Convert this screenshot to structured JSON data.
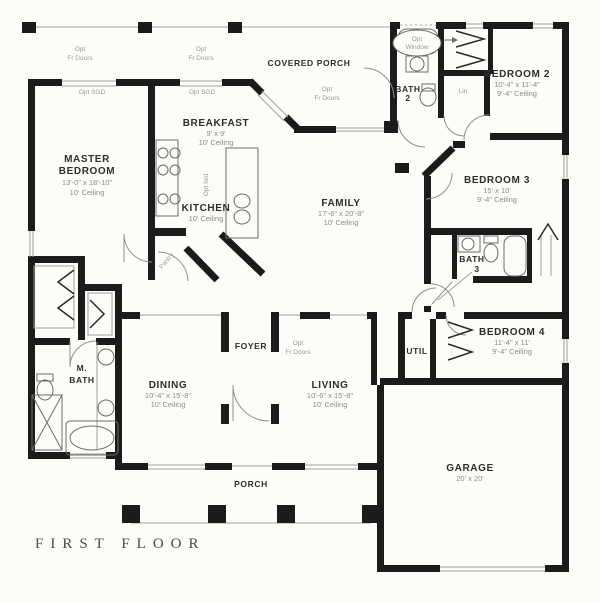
{
  "page": {
    "background": "#fcfcf8"
  },
  "colors": {
    "wall": "#1b1b1b",
    "thin_line": "#a0a0a0",
    "room_label": "#2e2e2e",
    "dim_label": "#8b8b8b",
    "annotation": "#9a9a9a",
    "title": "#4a4a4a"
  },
  "title": {
    "text": "FIRST FLOOR"
  },
  "rooms": {
    "covered_porch": {
      "name": "COVERED PORCH"
    },
    "master": {
      "line1": "MASTER",
      "line2": "BEDROOM",
      "dims": "13'-0\" x 18'-10\"",
      "ceiling": "10' Ceiling"
    },
    "breakfast": {
      "name": "BREAKFAST",
      "dims": "9' x 9'",
      "ceiling": "10' Ceiling"
    },
    "kitchen": {
      "name": "KITCHEN",
      "ceiling": "10' Ceiling"
    },
    "family": {
      "name": "FAMILY",
      "dims": "17'-6\" x 20'-8\"",
      "ceiling": "10' Ceiling"
    },
    "bath2": {
      "line1": "BATH",
      "line2": "2"
    },
    "bedroom2": {
      "name": "BEDROOM 2",
      "dims": "10'-4\" x 11'-4\"",
      "ceiling": "9'-4\" Ceiling"
    },
    "bedroom3": {
      "name": "BEDROOM 3",
      "dims": "15' x 10'",
      "ceiling": "9'-4\" Ceiling"
    },
    "bath3": {
      "line1": "BATH",
      "line2": "3"
    },
    "bedroom4": {
      "name": "BEDROOM 4",
      "dims": "11'-4\" x 11'",
      "ceiling": "9'-4\" Ceiling"
    },
    "util": {
      "name": "UTIL"
    },
    "garage": {
      "name": "GARAGE",
      "dims": "20' x 20'"
    },
    "foyer": {
      "name": "FOYER"
    },
    "dining": {
      "name": "DINING",
      "dims": "10'-4\" x 15'-8\"",
      "ceiling": "10' Ceiling"
    },
    "living": {
      "name": "LIVING",
      "dims": "10'-6\" x 15'-8\"",
      "ceiling": "10' Ceiling"
    },
    "master_bath": {
      "line1": "M.",
      "line2": "BATH"
    },
    "porch": {
      "name": "PORCH"
    }
  },
  "annotations": {
    "opt": "Opt",
    "fr_doors": "Fr Doors",
    "opt_sgd": "Opt SGD",
    "window": "Window",
    "opt_isld": "Opt Isld",
    "lin": "Lin",
    "pantry": "Pantry"
  }
}
